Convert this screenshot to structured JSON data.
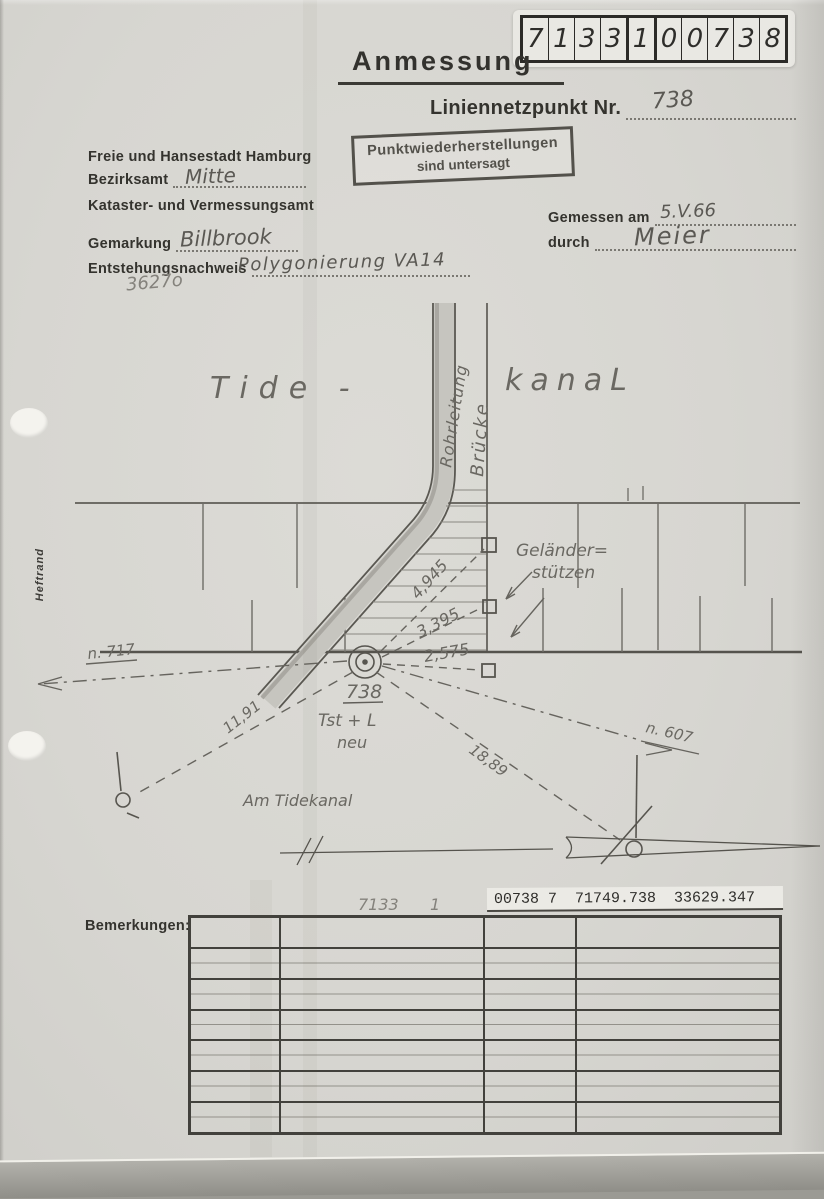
{
  "doc": {
    "number_digits": [
      "7",
      "1",
      "3",
      "3",
      "1",
      "0",
      "0",
      "7",
      "3",
      "8"
    ],
    "title": "Anmessung",
    "subtitle_label": "Liniennetzpunkt Nr.",
    "subtitle_value": "738",
    "stamp": {
      "line1": "Punktwiederherstellungen",
      "line2": "sind untersagt"
    },
    "margin_label": "Heftrand"
  },
  "office": {
    "city": "Freie und Hansestadt Hamburg",
    "bezirksamt_label": "Bezirksamt",
    "bezirksamt_value": "Mitte",
    "office_name": "Kataster- und Vermessungsamt",
    "gemarkung_label": "Gemarkung",
    "gemarkung_value": "Billbrook",
    "entstehung_label": "Entstehungsnachweis",
    "entstehung_value": "Polygonierung VA14",
    "pencil_note": "3627o"
  },
  "survey": {
    "date_label": "Gemessen am",
    "date_value": "5.V.66",
    "by_label": "durch",
    "by_value": "Meier"
  },
  "sketch": {
    "canal_left": "Tide -",
    "canal_right": "kanaL",
    "pipe_label": "Rohrleitung",
    "bridge_label": "Brücke",
    "railing_label1": "Geländer=",
    "railing_label2": "stützen",
    "point_number": "738",
    "point_type": "Tst + L",
    "point_note": "neu",
    "dist_railing1": "4,945",
    "dist_railing2": "3,395",
    "dist_railing3": "2,575",
    "dist_left": "11,91",
    "dist_right": "18,89",
    "ref_left": "n. 717",
    "ref_right": "n. 607",
    "street_name": "Am Tidekanal"
  },
  "footer": {
    "pencil_sheet": "7133",
    "pencil_index": "1",
    "label_strip": "00738 7  71749.738  33629.347",
    "bemerkungen_label": "Bemerkungen:"
  }
}
